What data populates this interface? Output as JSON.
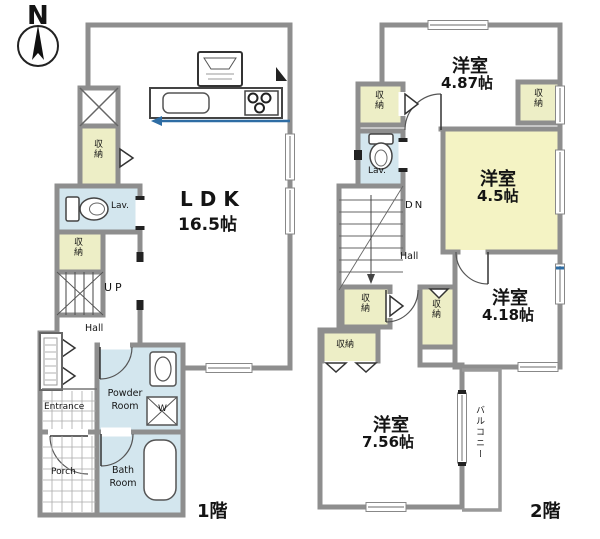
{
  "compass": {
    "label": "N"
  },
  "colors": {
    "wall": "#8e8e8e",
    "storage": "#edeec6",
    "wet": "#d3e6ee",
    "room_yellow": "#f4f3c4",
    "accent_blue": "#2e6da4"
  },
  "floor1": {
    "floor_label": "1階",
    "ldk_name": "LDK",
    "ldk_area": "16.5帖",
    "hall": "Hall",
    "up": "UP",
    "lav": "Lav.",
    "storage_a": "収納",
    "storage_b": "収納",
    "powder_room": "Powder Room",
    "bath_room": "Bath Room",
    "washer": "W",
    "entrance": "Entrance",
    "porch": "Porch"
  },
  "floor2": {
    "floor_label": "2階",
    "room_487_name": "洋室",
    "room_487_area": "4.87帖",
    "room_45_name": "洋室",
    "room_45_area": "4.5帖",
    "room_418_name": "洋室",
    "room_418_area": "4.18帖",
    "room_756_name": "洋室",
    "room_756_area": "7.56帖",
    "balcony": "バルコニー",
    "hall": "Hall",
    "dn": "DN",
    "lav": "Lav.",
    "storage_a": "収納",
    "storage_b": "収納",
    "storage_c": "収納",
    "storage_d": "収納",
    "storage_e": "収納"
  }
}
